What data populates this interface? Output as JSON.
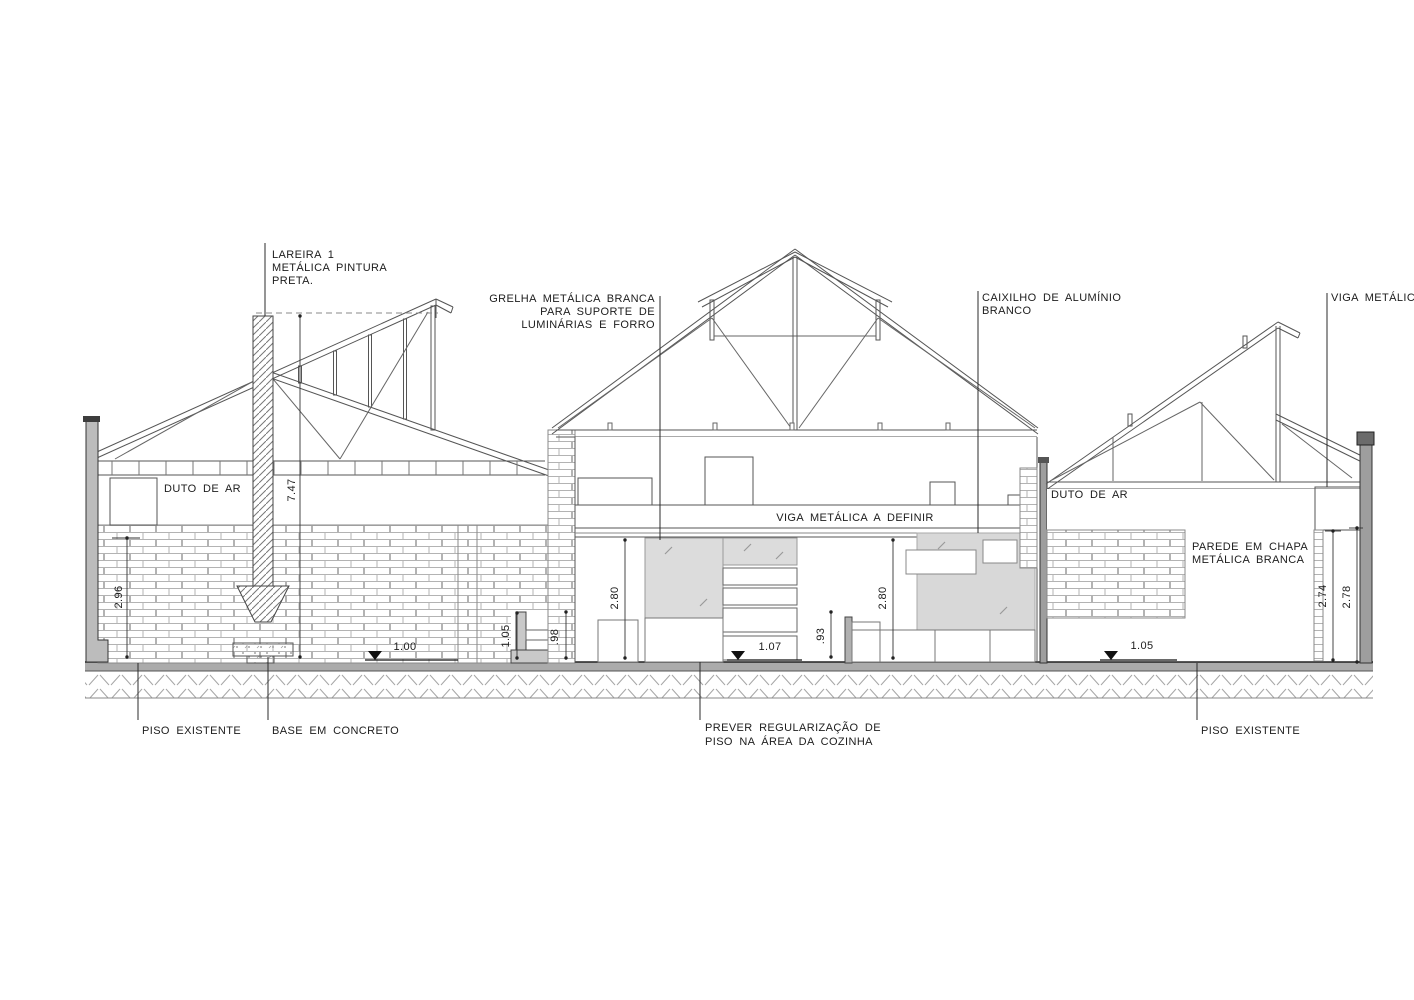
{
  "drawing": {
    "kind": "building cross-section",
    "colors": {
      "line": "#4a4a4a",
      "cut_wall_fill": "#b5b5b5",
      "glass_panel_fill": "#dcdcdc",
      "metal_sheet_fill": "#d8d8d8",
      "floor_slab_fill": "#ababab",
      "background": "#ffffff"
    },
    "labels": {
      "lareira_l1": "LAREIRA 1",
      "lareira_l2": "METÁLICA PINTURA",
      "lareira_l3": "PRETA.",
      "grelha_l1": "GRELHA METÁLICA BRANCA",
      "grelha_l2": "PARA SUPORTE DE",
      "grelha_l3": "LUMINÁRIAS E FORRO",
      "caixilho_l1": "CAIXILHO DE ALUMÍNIO",
      "caixilho_l2": "BRANCO",
      "viga_right": "VIGA METÁLICA .",
      "duto_left": "DUTO DE AR",
      "duto_right": "DUTO DE AR",
      "viga_center": "VIGA METÁLICA A DEFINIR",
      "parede_l1": "PAREDE EM CHAPA",
      "parede_l2": "METÁLICA BRANCA",
      "piso_left": "PISO EXISTENTE",
      "base_concreto": "BASE EM CONCRETO",
      "prever_l1": "PREVER REGULARIZAÇÃO DE",
      "prever_l2": "PISO NA ÁREA DA COZINHA",
      "piso_right": "PISO EXISTENTE"
    },
    "dimensions": {
      "chimney_height": "7.47",
      "left_wall_height": "2.96",
      "left_level": "1.00",
      "junction_left_height": "1.05",
      "junction_right_height": ".98",
      "room1_height": "2.80",
      "center_level": "1.07",
      "low_wall_height": ".93",
      "room2_height": "2.80",
      "right_level": "1.05",
      "right_inner_height": "2.74",
      "right_outer_height": "2.78"
    }
  }
}
